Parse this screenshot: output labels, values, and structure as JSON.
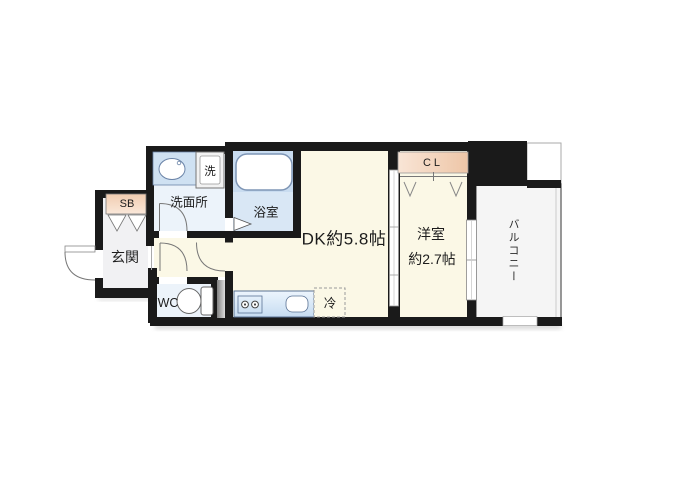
{
  "floorplan": {
    "rooms": {
      "dk": {
        "label": "DK約5.8帖"
      },
      "western_room": {
        "label_line1": "洋室",
        "label_line2": "約2.7帖"
      },
      "balcony": {
        "label": "バルコニー"
      },
      "entrance": {
        "label": "玄関"
      },
      "washroom": {
        "label": "洗面所"
      },
      "bathroom": {
        "label": "浴室"
      },
      "toilet": {
        "label": "WC"
      },
      "closet": {
        "label": "CL"
      },
      "shoe_box": {
        "label": "SB"
      },
      "washer_space": {
        "label": "洗"
      },
      "refrigerator_space": {
        "label": "冷"
      }
    },
    "colors": {
      "wall": "#1a1a1a",
      "living_floor": "#fbf8e6",
      "wet_area_floor": "#ecf3fa",
      "bathroom_floor": "#d9e7f5",
      "bathroom_upper": "#c9dcf0",
      "entrance_floor": "#f1f1f3",
      "balcony_floor": "#f5f5f5",
      "fixture_blue": "#cfe1f2"
    }
  }
}
